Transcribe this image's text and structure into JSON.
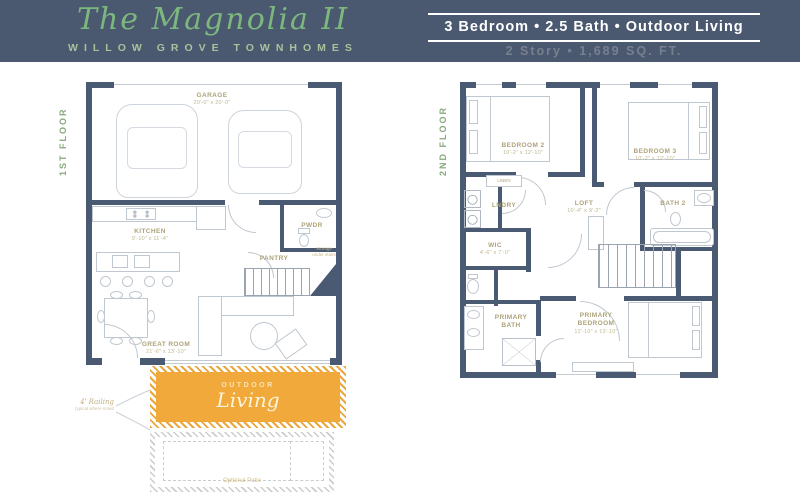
{
  "header": {
    "logo_title": "The Magnolia II",
    "logo_subtitle": "WILLOW GROVE TOWNHOMES",
    "specs_line": "3 Bedroom • 2.5 Bath • Outdoor Living",
    "details_line": "2 Story • 1,689 SQ. FT."
  },
  "floor1": {
    "floor_label": "1ST FLOOR",
    "garage": {
      "name": "GARAGE",
      "dims": "20'-0\" x 20'-0\""
    },
    "kitchen": {
      "name": "KITCHEN",
      "dims": "9'-10\" x 11'-4\""
    },
    "pwdr": {
      "name": "PWDR"
    },
    "pantry": {
      "name": "PANTRY"
    },
    "great_room": {
      "name": "GREAT ROOM",
      "dims": "21'-6\" x 13'-10\""
    },
    "storage_note": "Storage under stairs",
    "railing_note": {
      "line1": "4' Railing",
      "line2": "typical where noted"
    },
    "outdoor_living": {
      "word1": "OUTDOOR",
      "word2": "Living"
    },
    "patio_note": "Optional Patio"
  },
  "floor2": {
    "floor_label": "2ND FLOOR",
    "bedroom2": {
      "name": "BEDROOM 2",
      "dims": "10'-2\" x 12'-10\""
    },
    "bedroom3": {
      "name": "BEDROOM 3",
      "dims": "10'-2\" x 12'-10\""
    },
    "linen": {
      "name": "LINEN"
    },
    "lndry": {
      "name": "LNDRY"
    },
    "loft": {
      "name": "LOFT",
      "dims": "10'-4\" x 9'-2\""
    },
    "bath2": {
      "name": "BATH 2"
    },
    "wic": {
      "name": "WIC",
      "dims": "4'-6\" x 7'-0\""
    },
    "primary_bath": {
      "name": "PRIMARY BATH"
    },
    "primary_bedroom": {
      "name": "PRIMARY BEDROOM",
      "dims": "12'-10\" x 13'-10\""
    }
  },
  "colors": {
    "banner_bg": "#4A5870",
    "wall": "#4A5A72",
    "logo_green": "#7CB87E",
    "subtitle_green": "#A9C29B",
    "room_label_olive": "#ADA379",
    "outdoor_orange": "#F2A93B",
    "details_gray": "#76808F"
  }
}
